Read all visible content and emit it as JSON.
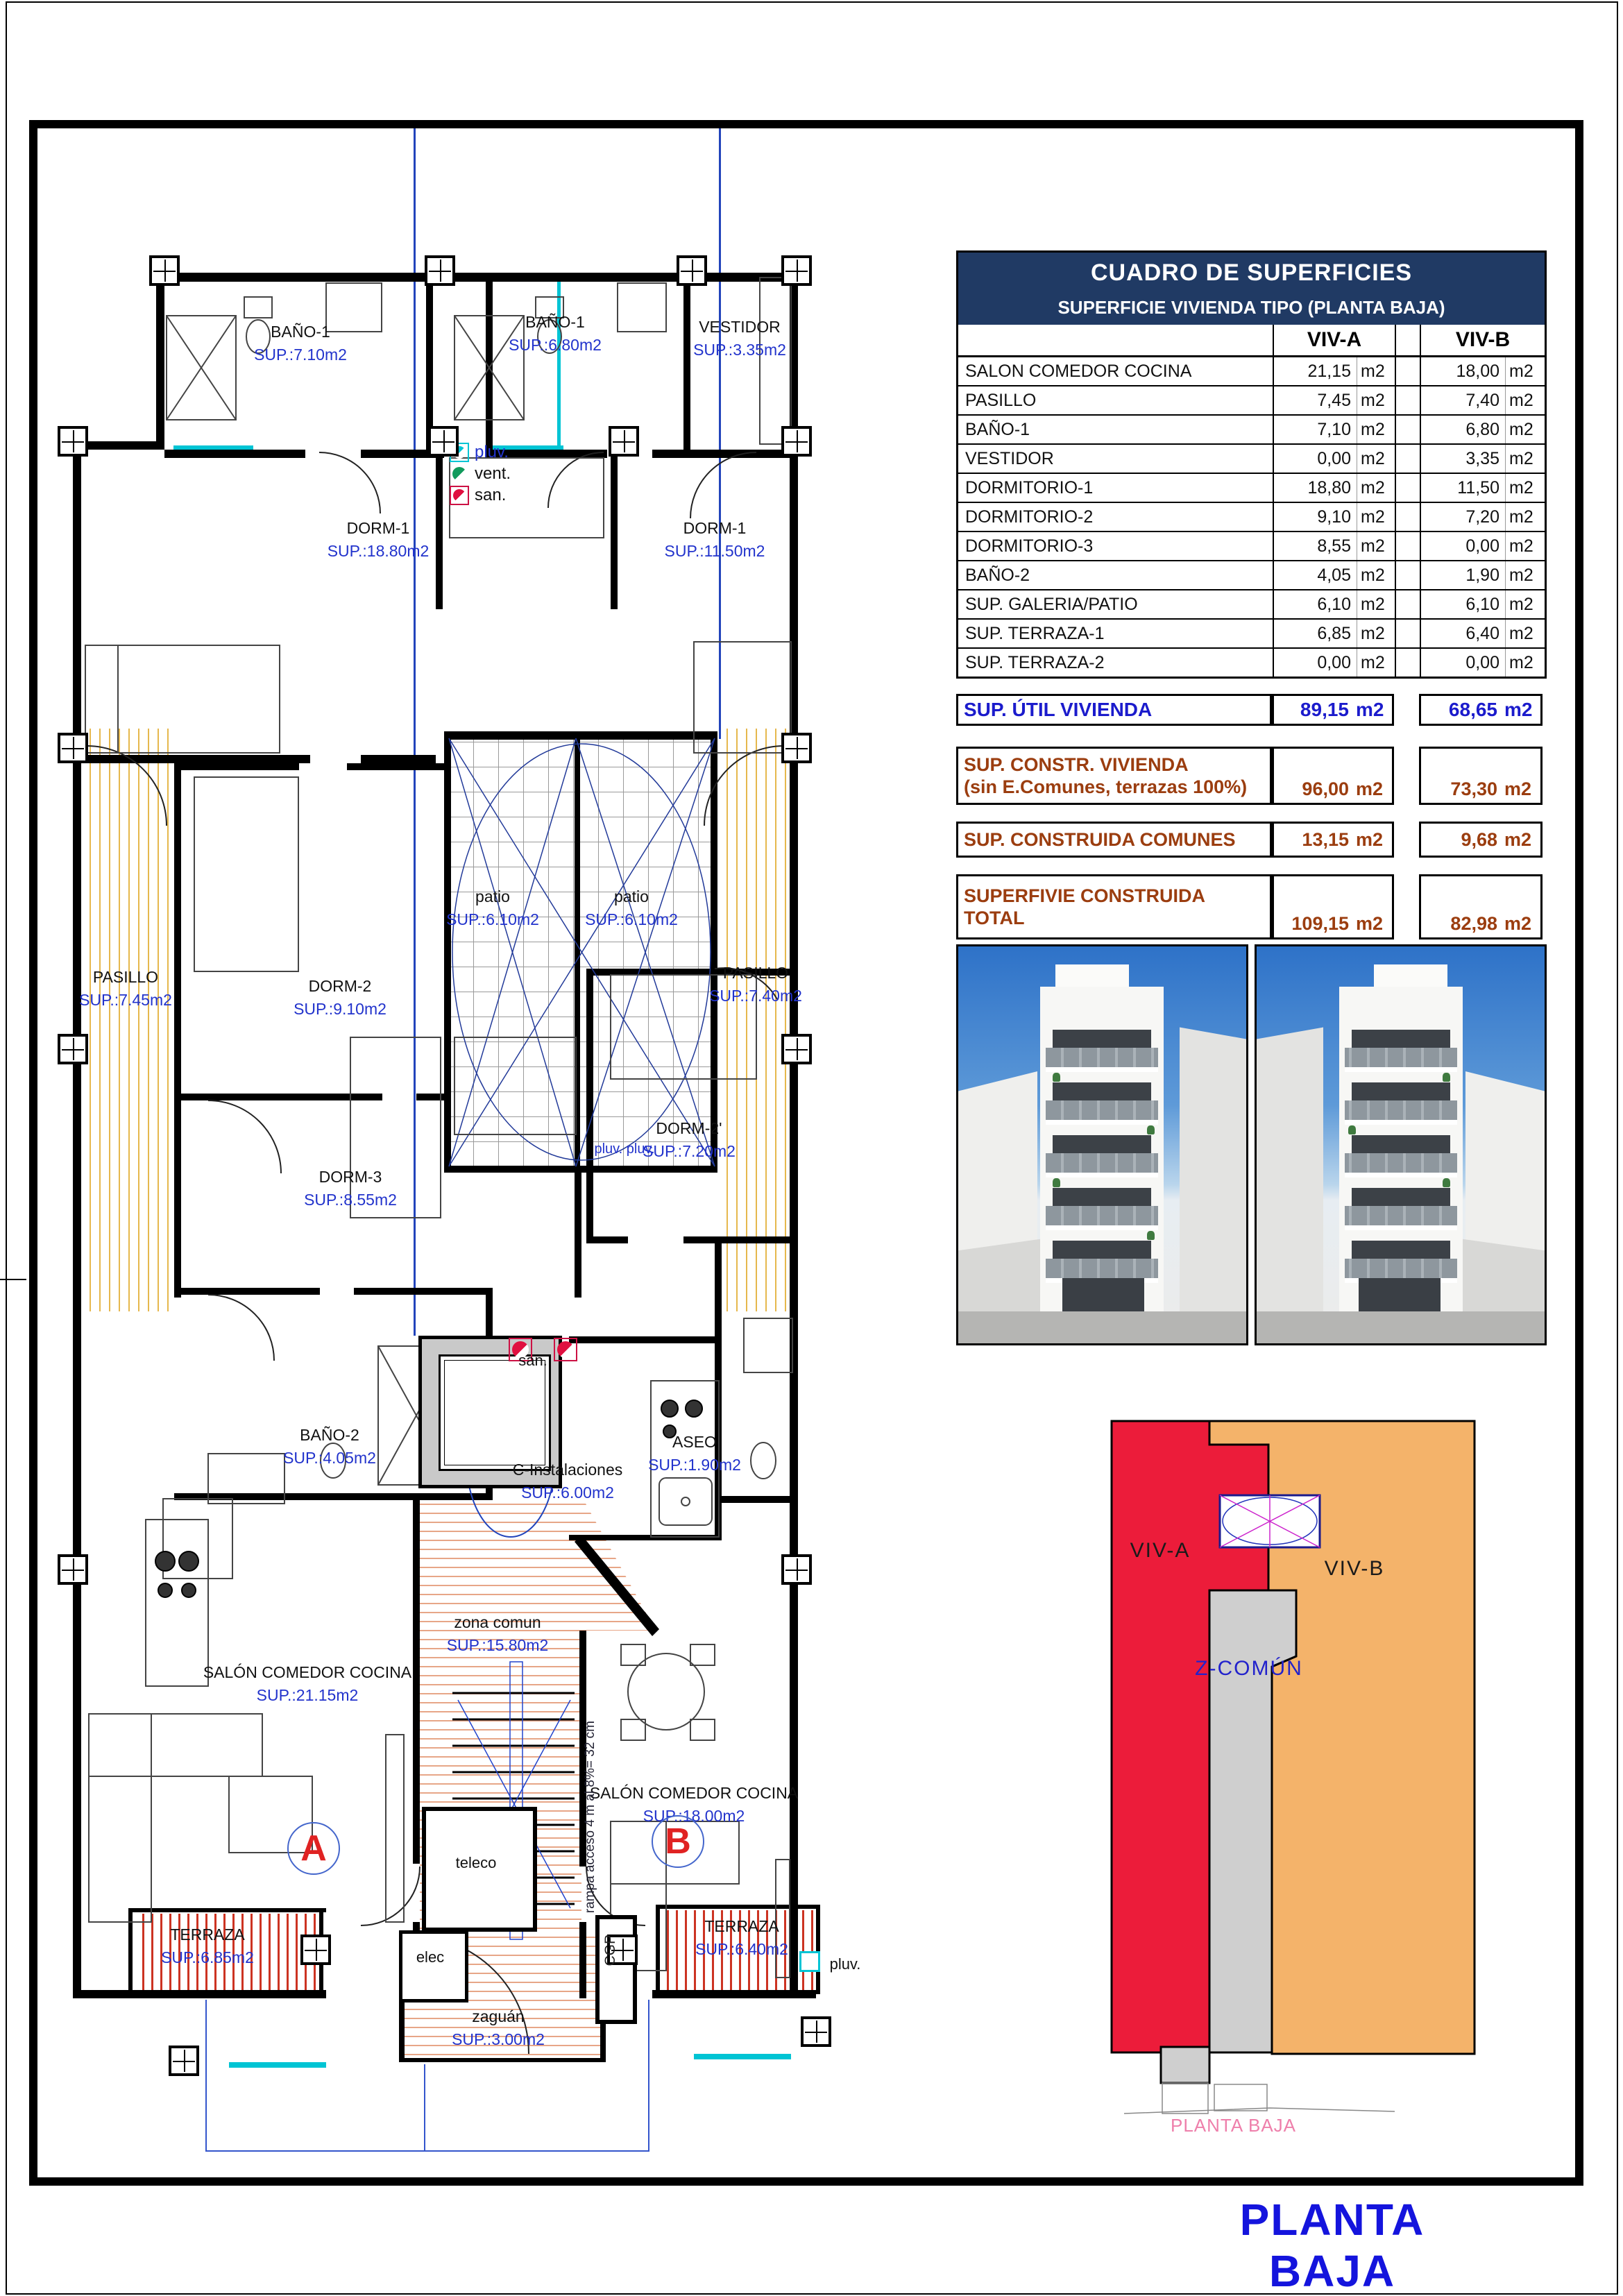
{
  "sheet": {
    "title_main": "PLANTA BAJA",
    "key_caption": "PLANTA BAJA"
  },
  "colors": {
    "table_header_bg": "#203a64",
    "plan_sup_blue": "#2233cc",
    "summary_blue": "#1b1bcc",
    "summary_brown": "#9b3d0f",
    "viv_a_red": "#ec1c3a",
    "viv_b_orange": "#f4b36a",
    "z_comun_gray": "#cfcfcf",
    "title_blue": "#1414dd",
    "caption_pink": "#ee7fab",
    "pluv_cyan": "#00c4d4"
  },
  "table": {
    "title": "CUADRO DE SUPERFICIES",
    "subtitle": "SUPERFICIE VIVIENDA TIPO  (PLANTA BAJA)",
    "columns": [
      "VIV-A",
      "VIV-B"
    ],
    "unit": "m2",
    "rows": [
      {
        "label": "SALON COMEDOR COCINA",
        "a": "21,15",
        "b": "18,00"
      },
      {
        "label": "PASILLO",
        "a": "7,45",
        "b": "7,40"
      },
      {
        "label": "BAÑO-1",
        "a": "7,10",
        "b": "6,80"
      },
      {
        "label": "VESTIDOR",
        "a": "0,00",
        "b": "3,35"
      },
      {
        "label": "DORMITORIO-1",
        "a": "18,80",
        "b": "11,50"
      },
      {
        "label": "DORMITORIO-2",
        "a": "9,10",
        "b": "7,20"
      },
      {
        "label": "DORMITORIO-3",
        "a": "8,55",
        "b": "0,00"
      },
      {
        "label": "BAÑO-2",
        "a": "4,05",
        "b": "1,90"
      },
      {
        "label": "SUP. GALERIA/PATIO",
        "a": "6,10",
        "b": "6,10"
      },
      {
        "label": "SUP. TERRAZA-1",
        "a": "6,85",
        "b": "6,40"
      },
      {
        "label": "SUP. TERRAZA-2",
        "a": "0,00",
        "b": "0,00"
      }
    ],
    "summary": [
      {
        "label": "SUP. ÚTIL VIVIENDA",
        "label2": "",
        "a": "89,15",
        "b": "68,65",
        "style": "blue"
      },
      {
        "label": "SUP. CONSTR. VIVIENDA",
        "label2": "(sin E.Comunes, terrazas 100%)",
        "a": "96,00",
        "b": "73,30",
        "style": "brown"
      },
      {
        "label": "SUP. CONSTRUIDA COMUNES",
        "label2": "",
        "a": "13,15",
        "b": "9,68",
        "style": "brown"
      },
      {
        "label": "SUPERFIVIE CONSTRUIDA",
        "label2": "TOTAL",
        "a": "109,15",
        "b": "82,98",
        "style": "brown"
      }
    ]
  },
  "plan": {
    "rooms": [
      {
        "name": "BAÑO-1",
        "sup": "SUP.:7.10m2"
      },
      {
        "name": "BAÑO-1",
        "sup": "SUP.:6.80m2"
      },
      {
        "name": "VESTIDOR",
        "sup": "SUP.:3.35m2"
      },
      {
        "name": "DORM-1",
        "sup": "SUP.:18.80m2"
      },
      {
        "name": "DORM-1",
        "sup": "SUP.:11.50m2"
      },
      {
        "name": "DORM-2",
        "sup": "SUP.:9.10m2"
      },
      {
        "name": "patio",
        "sup": "SUP.:6.10m2"
      },
      {
        "name": "patio",
        "sup": "SUP.:6.10m2"
      },
      {
        "name": "PASILLO",
        "sup": "SUP.:7.45m2"
      },
      {
        "name": "PASILLO",
        "sup": "SUP.:7.40m2"
      },
      {
        "name": "DORM-3",
        "sup": "SUP.:8.55m2"
      },
      {
        "name": "DORM-2'",
        "sup": "SUP.:7.20m2"
      },
      {
        "name": "BAÑO-2",
        "sup": "SUP.:4.05m2"
      },
      {
        "name": "C-Instalaciones",
        "sup": "SUP.:6.00m2"
      },
      {
        "name": "ASEO",
        "sup": "SUP.:1.90m2"
      },
      {
        "name": "SALÓN COMEDOR COCINA",
        "sup": "SUP.:21.15m2"
      },
      {
        "name": "zona comun",
        "sup": "SUP.:15.80m2"
      },
      {
        "name": "SALÓN COMEDOR COCINA",
        "sup": "SUP.:18.00m2"
      },
      {
        "name": "TERRAZA",
        "sup": "SUP.:6.85m2"
      },
      {
        "name": "TERRAZA",
        "sup": "SUP.:6.40m2"
      },
      {
        "name": "zaguán",
        "sup": "SUP.:3.00m2"
      }
    ],
    "legend": [
      {
        "icon": "pluv-icon",
        "label": "pluv.",
        "style": "blue"
      },
      {
        "icon": "vent-icon",
        "label": "vent.",
        "style": "black"
      },
      {
        "icon": "san-icon",
        "label": "san.",
        "style": "black"
      }
    ],
    "small_labels": {
      "san_shaft": "san.",
      "teleco": "teleco",
      "elec": "elec",
      "cgp": "CGP",
      "pluv_bottom": "pluv.",
      "pluv_patio": "pluv. pluv.",
      "ramp_note": "rampa acceso 4 m al 8%= 32 cm"
    },
    "unit_marks": [
      "A",
      "B"
    ]
  },
  "key_diagram": {
    "zones": [
      {
        "name": "VIV-A",
        "color": "#ec1c3a"
      },
      {
        "name": "VIV-B",
        "color": "#f4b36a"
      },
      {
        "name": "Z-COMÚN",
        "color": "#cfcfcf"
      }
    ],
    "caption": "PLANTA BAJA"
  }
}
